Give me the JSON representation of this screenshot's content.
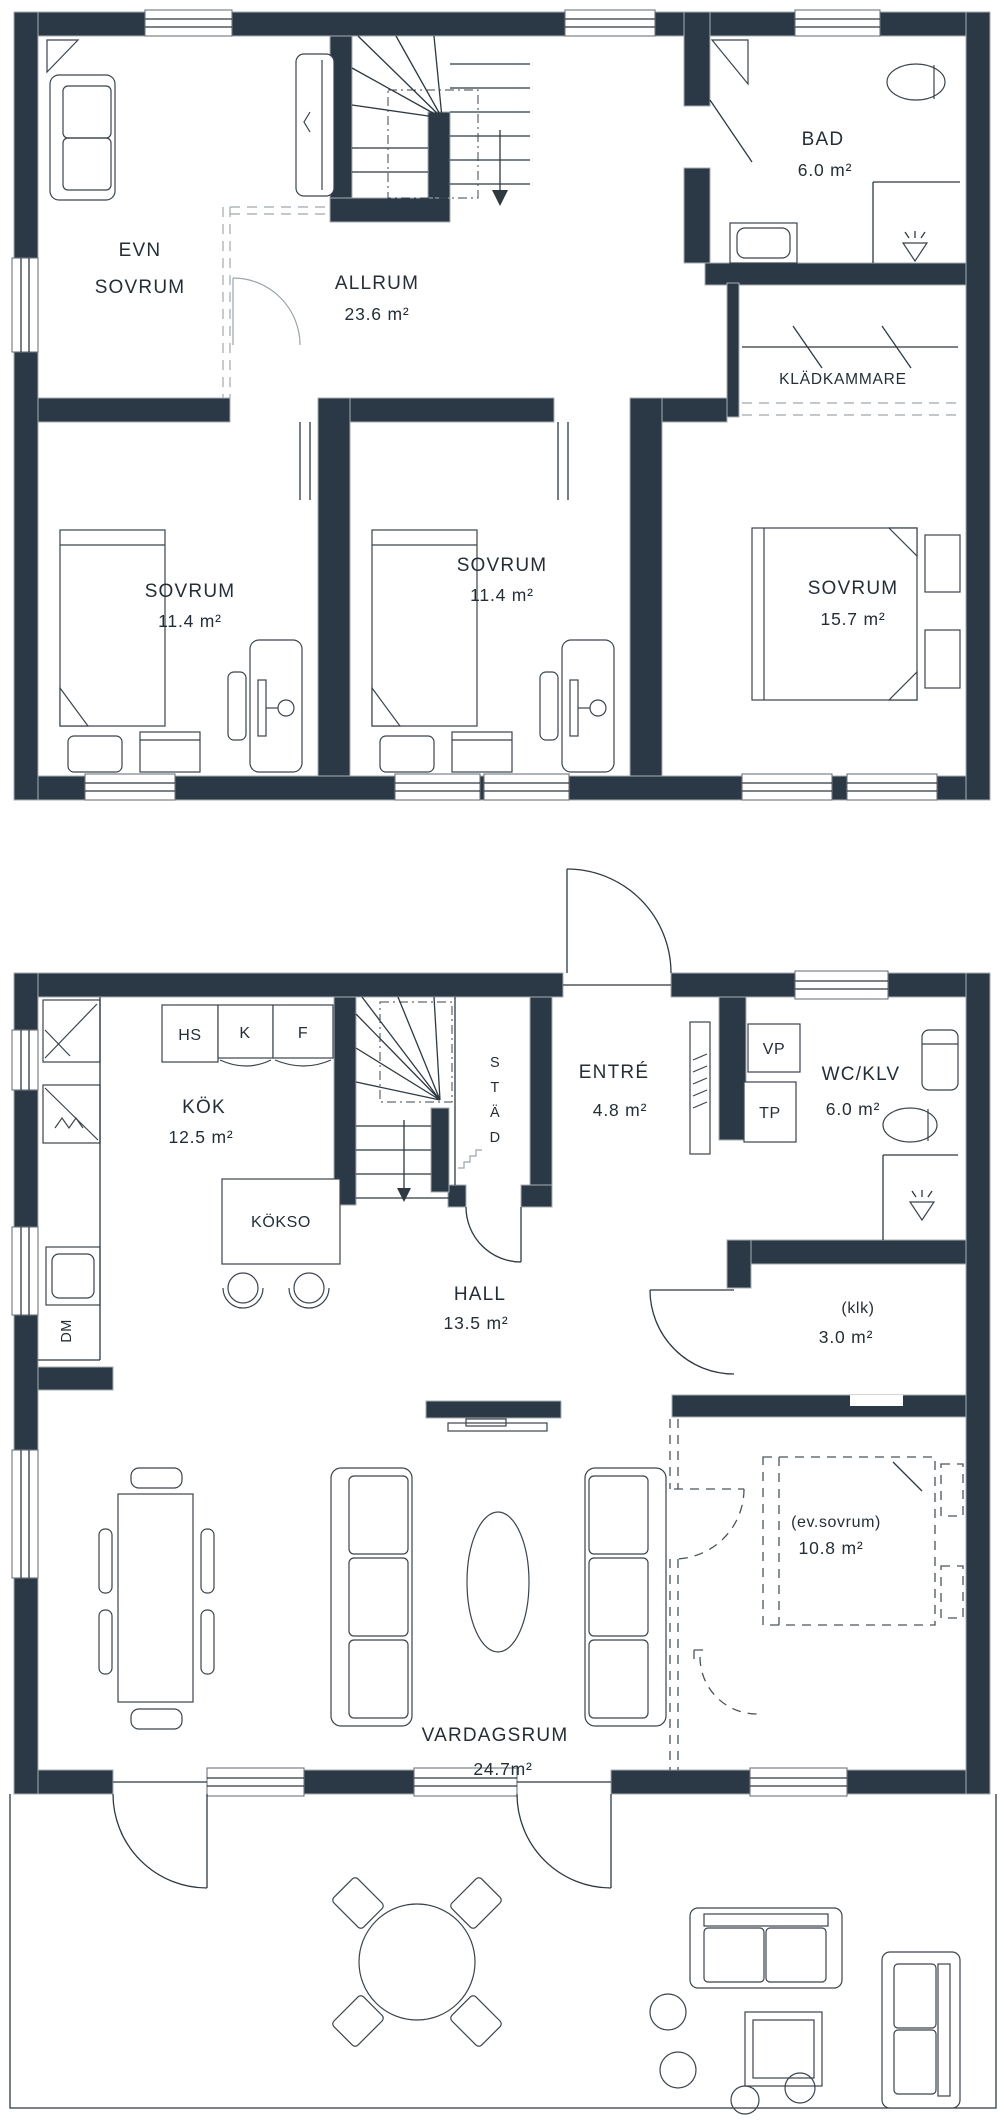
{
  "colors": {
    "wall": "#2b3946",
    "line": "#2e3942",
    "muted_line": "#9aa4ab",
    "dash_gray": "#aeb5bb",
    "text": "#242e38",
    "background": "#ffffff"
  },
  "upper_floor": {
    "rooms": {
      "evn_sovrum": {
        "line1": "EVN",
        "line2": "SOVRUM"
      },
      "allrum": {
        "name": "ALLRUM",
        "area": "23.6 m²"
      },
      "bad": {
        "name": "BAD",
        "area": "6.0 m²"
      },
      "kladkammare": {
        "name": "KLÄDKAMMARE"
      },
      "sovrum_left": {
        "name": "SOVRUM",
        "area": "11.4 m²"
      },
      "sovrum_mid": {
        "name": "SOVRUM",
        "area": "11.4 m²"
      },
      "sovrum_right": {
        "name": "SOVRUM",
        "area": "15.7 m²"
      }
    }
  },
  "ground_floor": {
    "rooms": {
      "kok": {
        "name": "KÖK",
        "area": "12.5 m²"
      },
      "entre": {
        "name": "ENTRÉ",
        "area": "4.8 m²"
      },
      "wc_klv": {
        "name": "WC/KLV",
        "area": "6.0 m²"
      },
      "hall": {
        "name": "HALL",
        "area": "13.5 m²"
      },
      "klk": {
        "name": "(klk)",
        "area": "3.0 m²"
      },
      "vardagsrum": {
        "name": "VARDAGSRUM",
        "area": "24.7m²"
      },
      "ev_sovrum": {
        "name": "(ev.sovrum)",
        "area": "10.8 m²"
      },
      "stad": {
        "letters": [
          "S",
          "T",
          "Ä",
          "D"
        ]
      }
    },
    "appliances": {
      "hs": "HS",
      "kyl": "K",
      "frys": "F",
      "kokso": "KÖKSO",
      "vp": "VP",
      "tp": "TP",
      "dm": "DM"
    }
  }
}
